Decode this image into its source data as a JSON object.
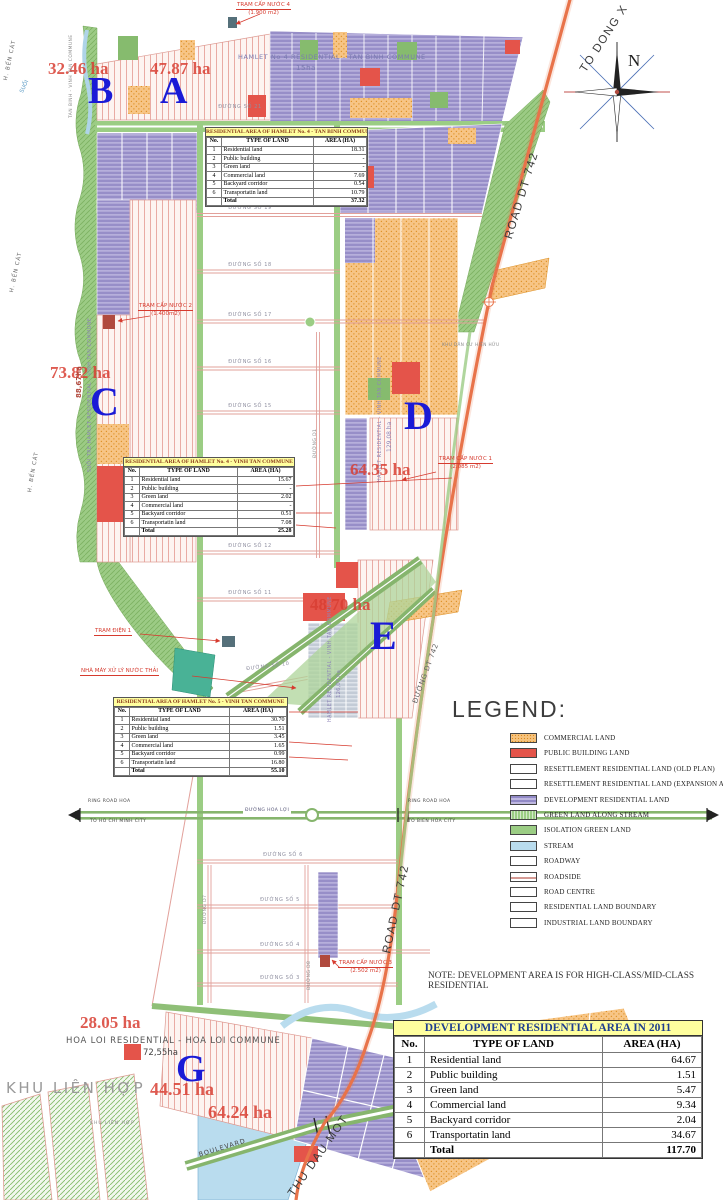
{
  "document": {
    "note": "NOTE: DEVELOPMENT AREA IS FOR HIGH-CLASS/MID-CLASS RESIDENTIAL"
  },
  "compass": {
    "north": "N"
  },
  "map": {
    "letters": {
      "a": "A",
      "b": "B",
      "c": "C",
      "d": "D",
      "e": "E",
      "g": "G"
    },
    "ha": {
      "a": "47.87 ha",
      "b": "32.46 ha",
      "c": "73.82 ha",
      "d": "64.35 ha",
      "e": "48.70 ha",
      "g_top": "28.05 ha",
      "g_mid": "44.51 ha",
      "g_bot": "64.24 ha"
    },
    "places": {
      "hamlet4_tb": "HAMLET No 4 RESIDENTIAL - TAN BINH COMMUNE",
      "hamlet4_tb_ha": "15ha",
      "hoa_loi": "HOA LOI RESIDENTIAL - HOA LOI COMMUNE",
      "hoa_loi_ha": "72,55ha",
      "khu_lien_hop": "KHU LIÊN HỢP",
      "khu_lien_hop_small": "KHU LIÊN HỢP",
      "khu_dan_cu": "KHU DÂN CƯ HIỆN HỮU",
      "h_ben_cat_1": "H. BẾN CÁT",
      "h_ben_cat_2": "H. BẾN CÁT",
      "h_ben_cat_3": "H. BẾN CÁT",
      "suoi": "SUỐI",
      "boundary_vert": "TAN BINH - VINH TAN COMMUNE",
      "vert_c_name": "SUỐI TRE HAMLET RESIDENTIAL - VINH TAN COMMUNE",
      "vert_c_ha": "88,67ha",
      "vert_d_name": "HAMLET RESIDENTIAL - VINH TAN COMMUNE",
      "vert_d_ha": "129,08 ha",
      "vert_e_name": "HAMLET RESIDENTIAL - VINH TAN COMMUNE",
      "vert_e_ha": "126,07 ha"
    },
    "annotations": {
      "tram_nuoc_4": "TRẠM CẤP NƯỚC 4",
      "tram_nuoc_4_size": "(1.900 m2)",
      "tram_nuoc_2": "TRẠM CẤP NƯỚC 2",
      "tram_nuoc_2_size": "(1.400m2)",
      "tram_nuoc_1": "TRẠM CẤP NƯỚC 1",
      "tram_nuoc_1_size": "(2.085 m2)",
      "tram_nuoc_3": "TRẠM CẤP NƯỚC 3",
      "tram_nuoc_3_size": "(2.502 m2)",
      "tram_dien": "TRẠM ĐIỆN 1",
      "nha_may": "NHÀ MÁY XỬ LÝ NƯỚC THẢI"
    },
    "roads": {
      "so21": "ĐƯỜNG SỐ 21",
      "so19": "ĐƯỜNG SỐ 19",
      "so18": "ĐƯỜNG SỐ 18",
      "so17": "ĐƯỜNG SỐ 17",
      "so16": "ĐƯỜNG SỐ 16",
      "so15": "ĐƯỜNG SỐ 15",
      "so12": "ĐƯỜNG SỐ 12",
      "so11": "ĐƯỜNG SỐ 11",
      "so10": "ĐƯỜNG SỐ 10",
      "so6": "ĐƯỜNG SỐ 6",
      "so5": "ĐƯỜNG SỐ 5",
      "so4": "ĐƯỜNG SỐ 4",
      "so3": "ĐƯỜNG SỐ 3",
      "d1": "ĐƯỜNG D1",
      "d7": "ĐƯỜNG D7",
      "d8": "ĐƯỜNG D8",
      "hoa_loi_road": "ĐƯỜNG HOA LỢI",
      "dt742_top": "ROAD DT 742",
      "dt742_mid": "ĐƯỜNG DT 742",
      "dt742_bot": "ROAD DT 742",
      "to_dong_xoai": "TO DONG X",
      "thu_dau_mot": "THU DAU MOT",
      "boulevard": "BOULEVARD",
      "ring_left_1": "RING ROAD HOA",
      "ring_left_2": "TO HO CHI MINH CITY",
      "ring_right_1": "RING ROAD HOA",
      "ring_right_2": "TO BIEN HOA CITY"
    }
  },
  "tables": {
    "cols": {
      "no": "No.",
      "type": "TYPE OF LAND",
      "area": "AREA (HA)"
    },
    "t1": {
      "title": "RESIDENTIAL AREA OF HAMLET No. 4 - TAN BINH COMMUNE",
      "rows": [
        [
          "1",
          "Residential land",
          "18.31"
        ],
        [
          "2",
          "Public building",
          "-"
        ],
        [
          "3",
          "Green land",
          "-"
        ],
        [
          "4",
          "Commercial land",
          "7.69"
        ],
        [
          "5",
          "Backyard corridor",
          "0.54"
        ],
        [
          "6",
          "Transportatin land",
          "10.79"
        ],
        [
          "",
          "Total",
          "37.32"
        ]
      ]
    },
    "t2": {
      "title": "RESIDENTIAL AREA OF HAMLET No. 4 - VINH TAN COMMUNE",
      "rows": [
        [
          "1",
          "Residential land",
          "15.67"
        ],
        [
          "2",
          "Public building",
          "-"
        ],
        [
          "3",
          "Green land",
          "2.02"
        ],
        [
          "4",
          "Commercial land",
          "-"
        ],
        [
          "5",
          "Backyard corridor",
          "0.51"
        ],
        [
          "6",
          "Transportatin land",
          "7.08"
        ],
        [
          "",
          "Total",
          "25.28"
        ]
      ]
    },
    "t3": {
      "title": "RESIDENTIAL AREA OF HAMLET No. 5 - VINH TAN COMMUNE",
      "rows": [
        [
          "1",
          "Residential land",
          "30.70"
        ],
        [
          "2",
          "Public building",
          "1.51"
        ],
        [
          "3",
          "Green land",
          "3.45"
        ],
        [
          "4",
          "Commercial land",
          "1.65"
        ],
        [
          "5",
          "Backyard corridor",
          "0.99"
        ],
        [
          "6",
          "Transportatin land",
          "16.80"
        ],
        [
          "",
          "Total",
          "55.10"
        ]
      ]
    },
    "dev": {
      "title": "DEVELOPMENT RESIDENTIAL AREA IN 2011",
      "rows": [
        [
          "1",
          "Residential land",
          "64.67"
        ],
        [
          "2",
          "Public building",
          "1.51"
        ],
        [
          "3",
          "Green land",
          "5.47"
        ],
        [
          "4",
          "Commercial land",
          "9.34"
        ],
        [
          "5",
          "Backyard corridor",
          "2.04"
        ],
        [
          "6",
          "Transportatin land",
          "34.67"
        ],
        [
          "",
          "Total",
          "117.70"
        ]
      ]
    }
  },
  "legend": {
    "title": "LEGEND:",
    "items": [
      "COMMERCIAL LAND",
      "PUBLIC BUILDING LAND",
      "RESETTLEMENT RESIDENTIAL LAND (OLD PLAN)",
      "RESETTLEMENT RESIDENTIAL LAND (EXPANSION AREA)",
      "DEVELOPMENT RESIDENTIAL LAND",
      "GREEN LAND ALONG STREAM",
      "ISOLATION GREEN LAND",
      "STREAM",
      "ROADWAY",
      "ROADSIDE",
      "ROAD CENTRE",
      "RESIDENTIAL LAND BOUNDARY",
      "INDUSTRIAL LAND BOUNDARY"
    ]
  },
  "colors": {
    "commercial": "#f6c27d",
    "public_building": "#e4544a",
    "development_residential": "#978ec8",
    "green_land": "#9bcd84",
    "stream": "#b9dcee",
    "road_dt742": "#e8734a",
    "area_letter_blue": "#1a1ad6",
    "ha_label_red": "#d83e32",
    "table_header_yellow": "#ffff9e"
  }
}
